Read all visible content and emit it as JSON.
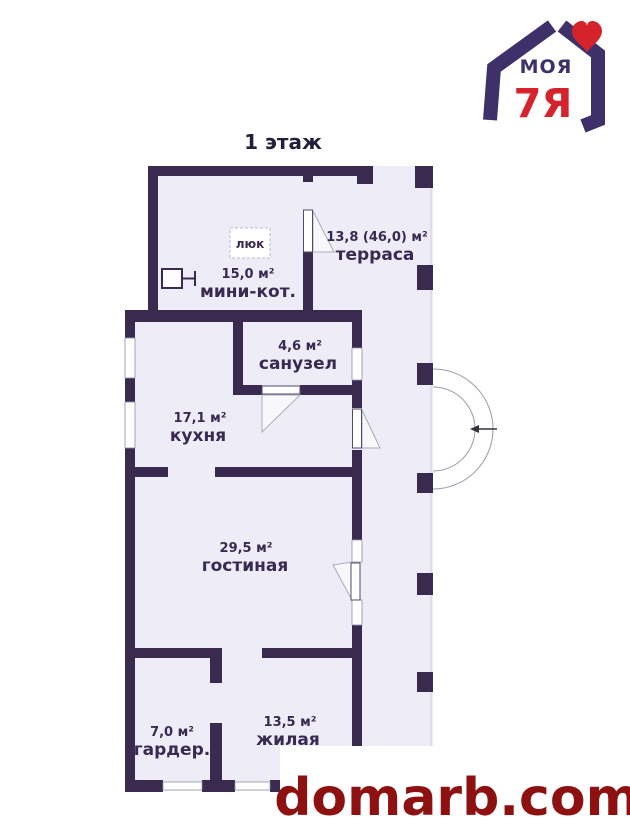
{
  "page": {
    "title": "1 этаж",
    "background": "#ffffff"
  },
  "watermark": {
    "text": "domarb.com",
    "color": "#8e1111"
  },
  "logo": {
    "word_top": "МОЯ",
    "word_bottom": "7Я",
    "color_primary": "#3e3169",
    "color_accent": "#d6232b"
  },
  "plan": {
    "wall_color": "#3a2a50",
    "floor_color": "#edecf7",
    "hatch_label": "люк",
    "rooms": {
      "boiler": {
        "name": "мини-кот.",
        "area": "15,0 м²"
      },
      "terrace": {
        "name": "терраса",
        "area": "13,8 (46,0) м²"
      },
      "bathroom": {
        "name": "санузел",
        "area": "4,6 м²"
      },
      "kitchen": {
        "name": "кухня",
        "area": "17,1 м²"
      },
      "living": {
        "name": "гостиная",
        "area": "29,5 м²"
      },
      "wardrobe": {
        "name": "гардер.",
        "area": "7,0 м²"
      },
      "bedroom": {
        "name": "жилая",
        "area": "13,5 м²"
      }
    }
  }
}
